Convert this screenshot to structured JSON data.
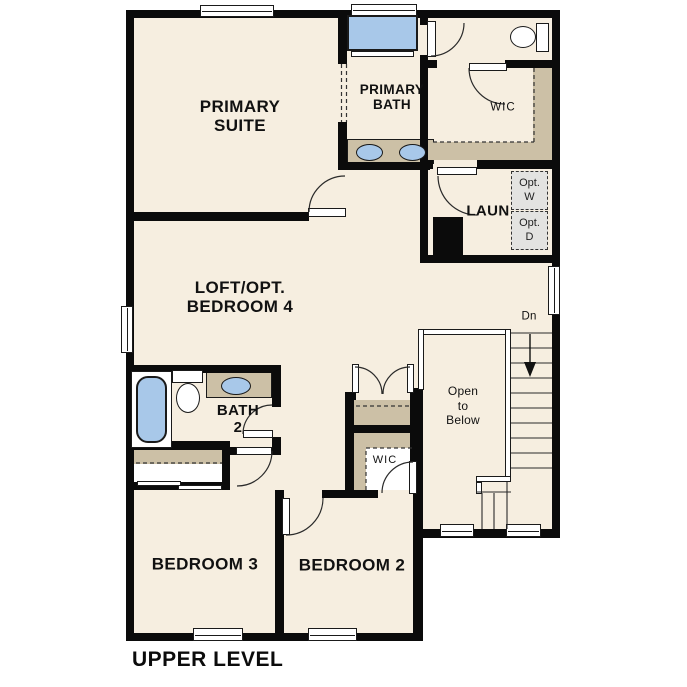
{
  "title": {
    "label": "UPPER LEVEL"
  },
  "rooms": {
    "primary_suite": {
      "lines": [
        "PRIMARY",
        "SUITE"
      ]
    },
    "primary_bath": {
      "lines": [
        "PRIMARY",
        "BATH"
      ]
    },
    "primary_wic": {
      "label": "WIC"
    },
    "laundry": {
      "label": "LAUN"
    },
    "opt_washer": {
      "lines": [
        "Opt.",
        "W"
      ]
    },
    "opt_dryer": {
      "lines": [
        "Opt.",
        "D"
      ]
    },
    "loft": {
      "lines": [
        "LOFT/OPT.",
        "BEDROOM 4"
      ]
    },
    "bath2": {
      "lines": [
        "BATH",
        "2"
      ]
    },
    "bedroom3": {
      "label": "BEDROOM 3"
    },
    "bedroom2": {
      "label": "BEDROOM 2"
    },
    "bedroom2_wic": {
      "label": "WIC"
    },
    "stairs": {
      "direction_label": "Dn"
    },
    "open_to_below": {
      "lines": [
        "Open",
        "to",
        "Below"
      ]
    }
  },
  "colors": {
    "wall": "#0b0b0b",
    "floor": "#f6eee0",
    "counter_tan": "#ccc0a6",
    "fixture_blue": "#a8c8e9",
    "optional_appliance_fill": "#e3e3e1",
    "background": "#ffffff"
  }
}
